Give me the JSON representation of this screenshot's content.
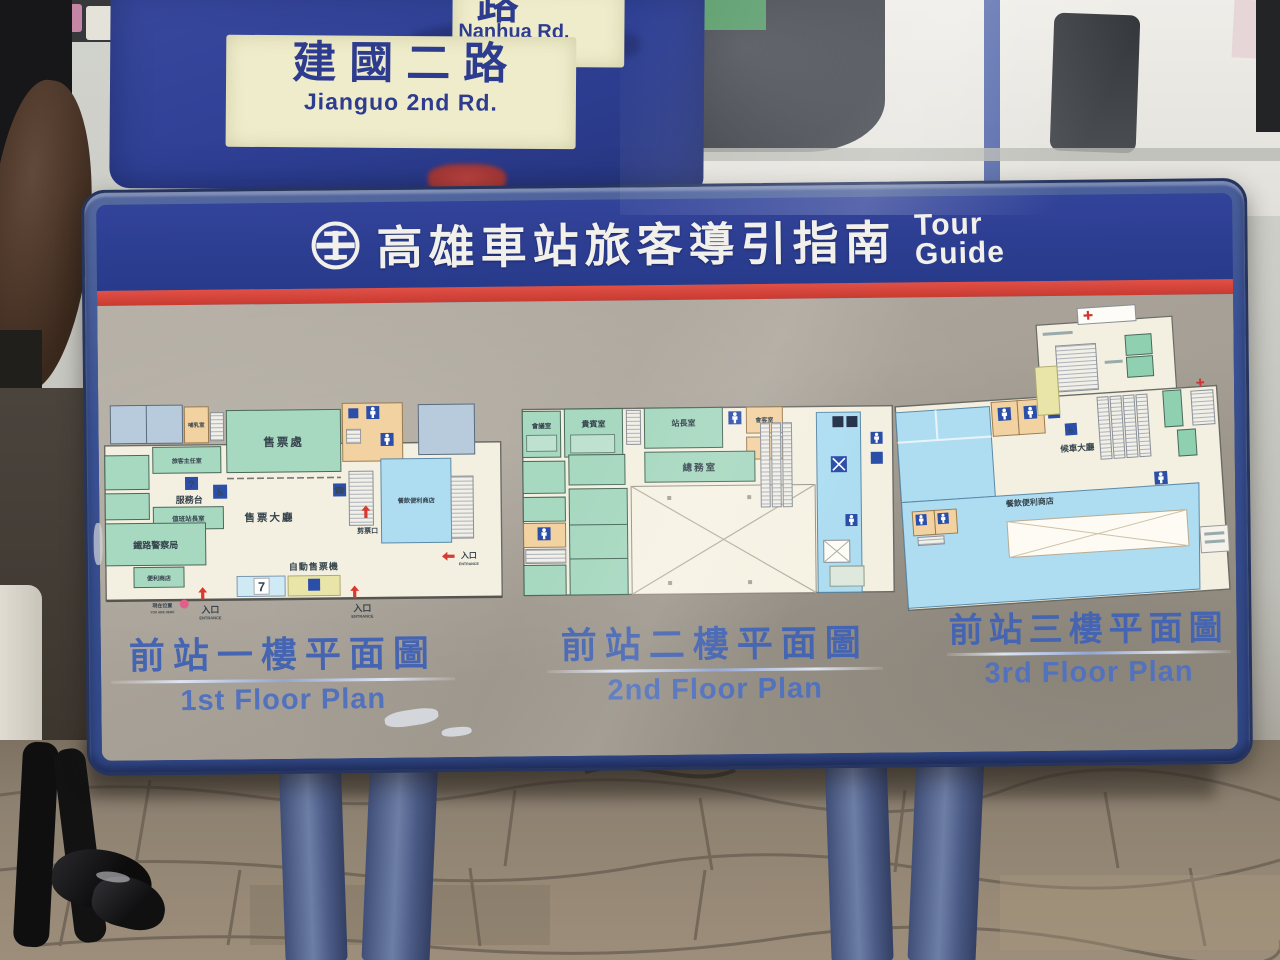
{
  "scene": {
    "street_sign": {
      "main_cn": "建國二路",
      "main_en": "Jianguo 2nd Rd.",
      "side_cn": "路",
      "side_en": "Nanhua Rd."
    },
    "board": {
      "title_cn": "高雄車站旅客導引指南",
      "title_en_1": "Tour",
      "title_en_2": "Guide"
    },
    "floors": [
      {
        "caption_cn": "前站一樓平面圖",
        "caption_en": "1st Floor Plan",
        "labels": {
          "nursing": "哺乳室",
          "chief": "旅客主任室",
          "info_desk": "服務台",
          "duty_master": "值班站長室",
          "police": "鐵路警察局",
          "ticket_office": "售票處",
          "ticket_hall": "售票大廳",
          "tvm": "自動售票機",
          "store": "便利商店",
          "food_store": "餐飲便利商店",
          "gate": "剪票口",
          "entrance_cn": "入口",
          "entrance_en": "ENTRANCE",
          "here_cn": "現在位置",
          "here_en": "YOU ARE HERE"
        }
      },
      {
        "caption_cn": "前站二樓平面圖",
        "caption_en": "2nd Floor Plan",
        "labels": {
          "meeting": "會議室",
          "vip": "貴賓室",
          "master": "站長室",
          "reception": "會客室",
          "affairs": "總務室"
        }
      },
      {
        "caption_cn": "前站三樓平面圖",
        "caption_en": "3rd Floor Plan",
        "labels": {
          "waiting": "候車大廳",
          "food_store": "餐飲便利商店"
        }
      }
    ],
    "icons": {
      "info": "?",
      "phone": "☎",
      "wheelchair": "♿",
      "seven": "7"
    },
    "colors": {
      "board_frame": "#3c58a0",
      "header_blue": "#2b3c8c",
      "stripe_red": "#d6453c",
      "body_putty": "#a8a197",
      "caption_blue": "#4565b2",
      "sign_blue": "#2e3f94",
      "sign_panel": "#efeccb",
      "plan_floor": "#f4f0e1",
      "room_green": "#a7d8c0",
      "store_blue": "#aeddf2",
      "service_tan": "#f3d2a2",
      "machine_yellow": "#e9e5a9",
      "icon_blue": "#2b4ea8",
      "accent_red": "#d93a30"
    }
  }
}
